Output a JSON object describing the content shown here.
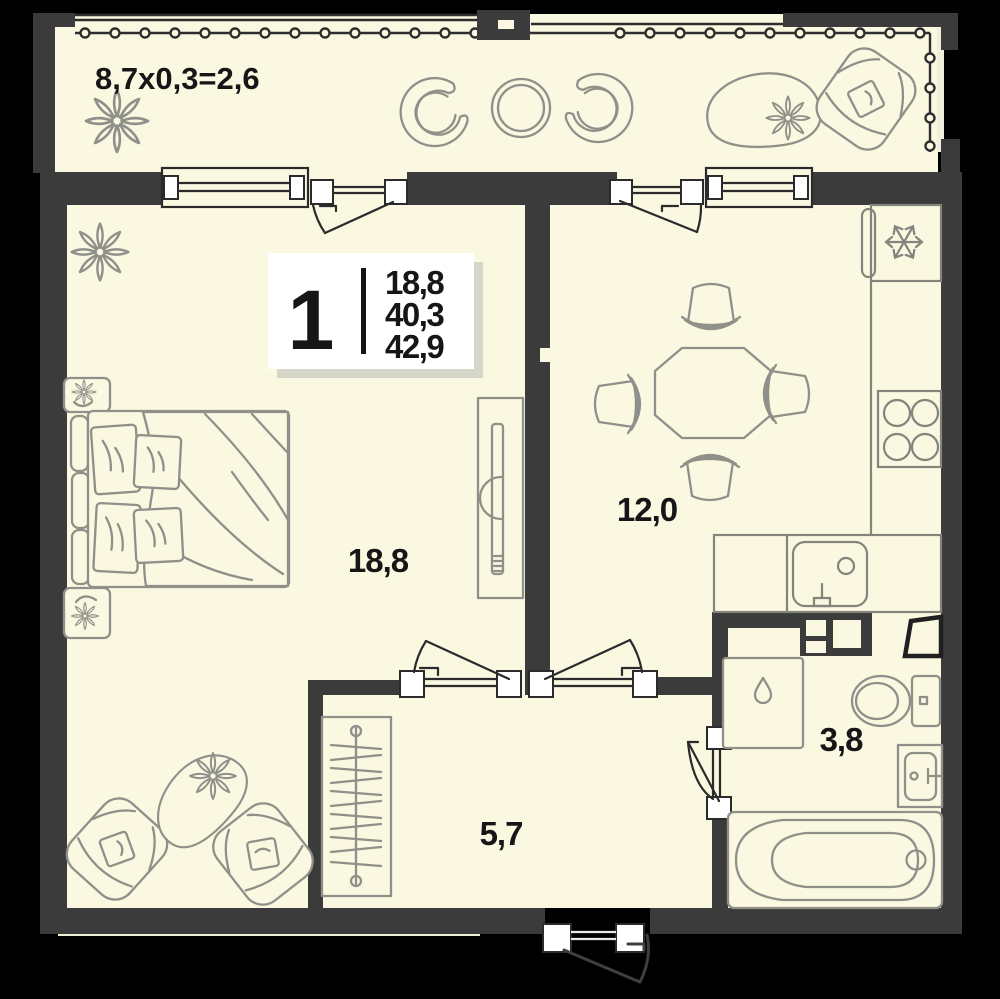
{
  "plan": {
    "card": {
      "rooms": "1",
      "living_area": "18,8",
      "apartment_area": "40,3",
      "total_area": "42,9"
    },
    "balcony": {
      "formula": "8,7x0,3=2,6"
    },
    "rooms": {
      "living": "18,8",
      "kitchen": "12,0",
      "hallway": "5,7",
      "bathroom": "3,8"
    },
    "colors": {
      "background": "#000000",
      "floor": "#FAF8E1",
      "wall": "#3B3B3B",
      "furniture_line": "#8F9089",
      "text": "#161616",
      "card_shadow": "#D6D6C8"
    }
  }
}
